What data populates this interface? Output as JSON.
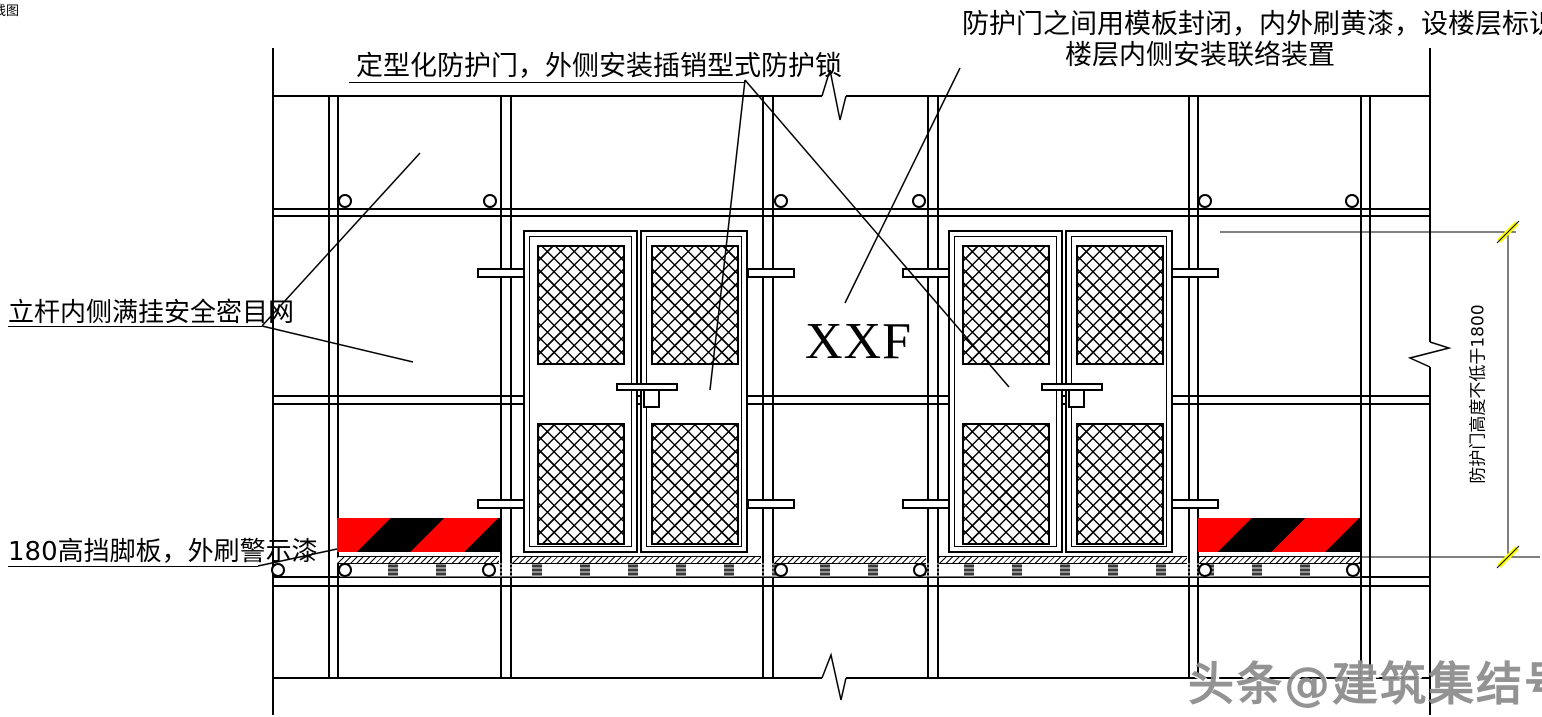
{
  "corner_text": "线图",
  "annotations": {
    "door_label": "定型化防护门，外侧安装插销型式防护锁",
    "formwork_label_line1": "防护门之间用模板封闭，内外刷黄漆，设楼层标识。",
    "formwork_label_line2": "楼层内侧安装联络装置",
    "net_label": "立杆内侧满挂安全密目网",
    "toeboard_label": "180高挡脚板，外刷警示漆",
    "center_mark": "XXF",
    "dimension_note": "防护门高度不低于1800"
  },
  "watermark": "头条@建筑集结号",
  "colors": {
    "line": "#000000",
    "toeboard_red": "#ff0000",
    "toeboard_black": "#000000",
    "dimension_tick_yellow": "#ffff00",
    "watermark_gray": "#8a8a8a",
    "background": "#ffffff"
  }
}
